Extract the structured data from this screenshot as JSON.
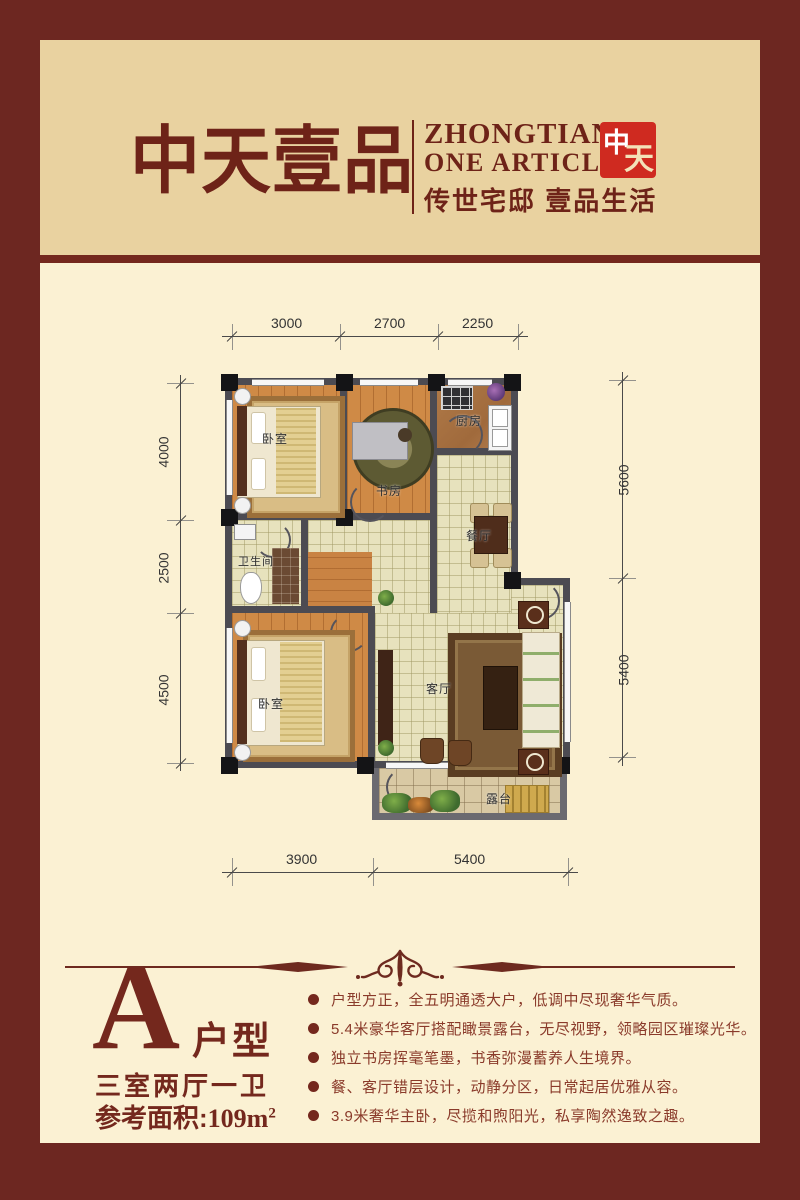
{
  "brand": {
    "title_cn": "中天壹品",
    "en_line1": "ZHONGTIAN",
    "en_line2": "ONE ARTICLE",
    "tagline": "传世宅邸 壹品生活",
    "seal_char1": "中",
    "seal_char2": "天"
  },
  "floorplan": {
    "rooms": {
      "bedroom1": "卧室",
      "study": "书房",
      "kitchen": "厨房",
      "dining": "餐厅",
      "bathroom": "卫生间",
      "bedroom2": "卧室",
      "living": "客厅",
      "terrace": "露台"
    },
    "dims": {
      "top": [
        "3000",
        "2700",
        "2250"
      ],
      "bottom": [
        "3900",
        "5400"
      ],
      "left": [
        "4000",
        "2500",
        "4500"
      ],
      "right": [
        "5600",
        "5400"
      ]
    }
  },
  "unit": {
    "type_letter": "A",
    "type_suffix": "户型",
    "layout": "三室两厅一卫",
    "area_prefix": "参考面积:",
    "area_value": "109m",
    "area_sup": "2"
  },
  "features": [
    "户型方正，全五明通透大户，低调中尽现奢华气质。",
    "5.4米豪华客厅搭配瞰景露台，无尽视野，领略园区璀璨光华。",
    "独立书房挥毫笔墨，书香弥漫蓄养人生境界。",
    "餐、客厅错层设计，动静分区，日常起居优雅从容。",
    "3.9米奢华主卧，尽揽和煦阳光，私享陶然逸致之趣。"
  ],
  "colors": {
    "frame": "#6d2721",
    "panel_top": "#e9d2a0",
    "panel_main": "#fbf1d3",
    "accent": "#74281d",
    "seal_red": "#cf2a20"
  }
}
